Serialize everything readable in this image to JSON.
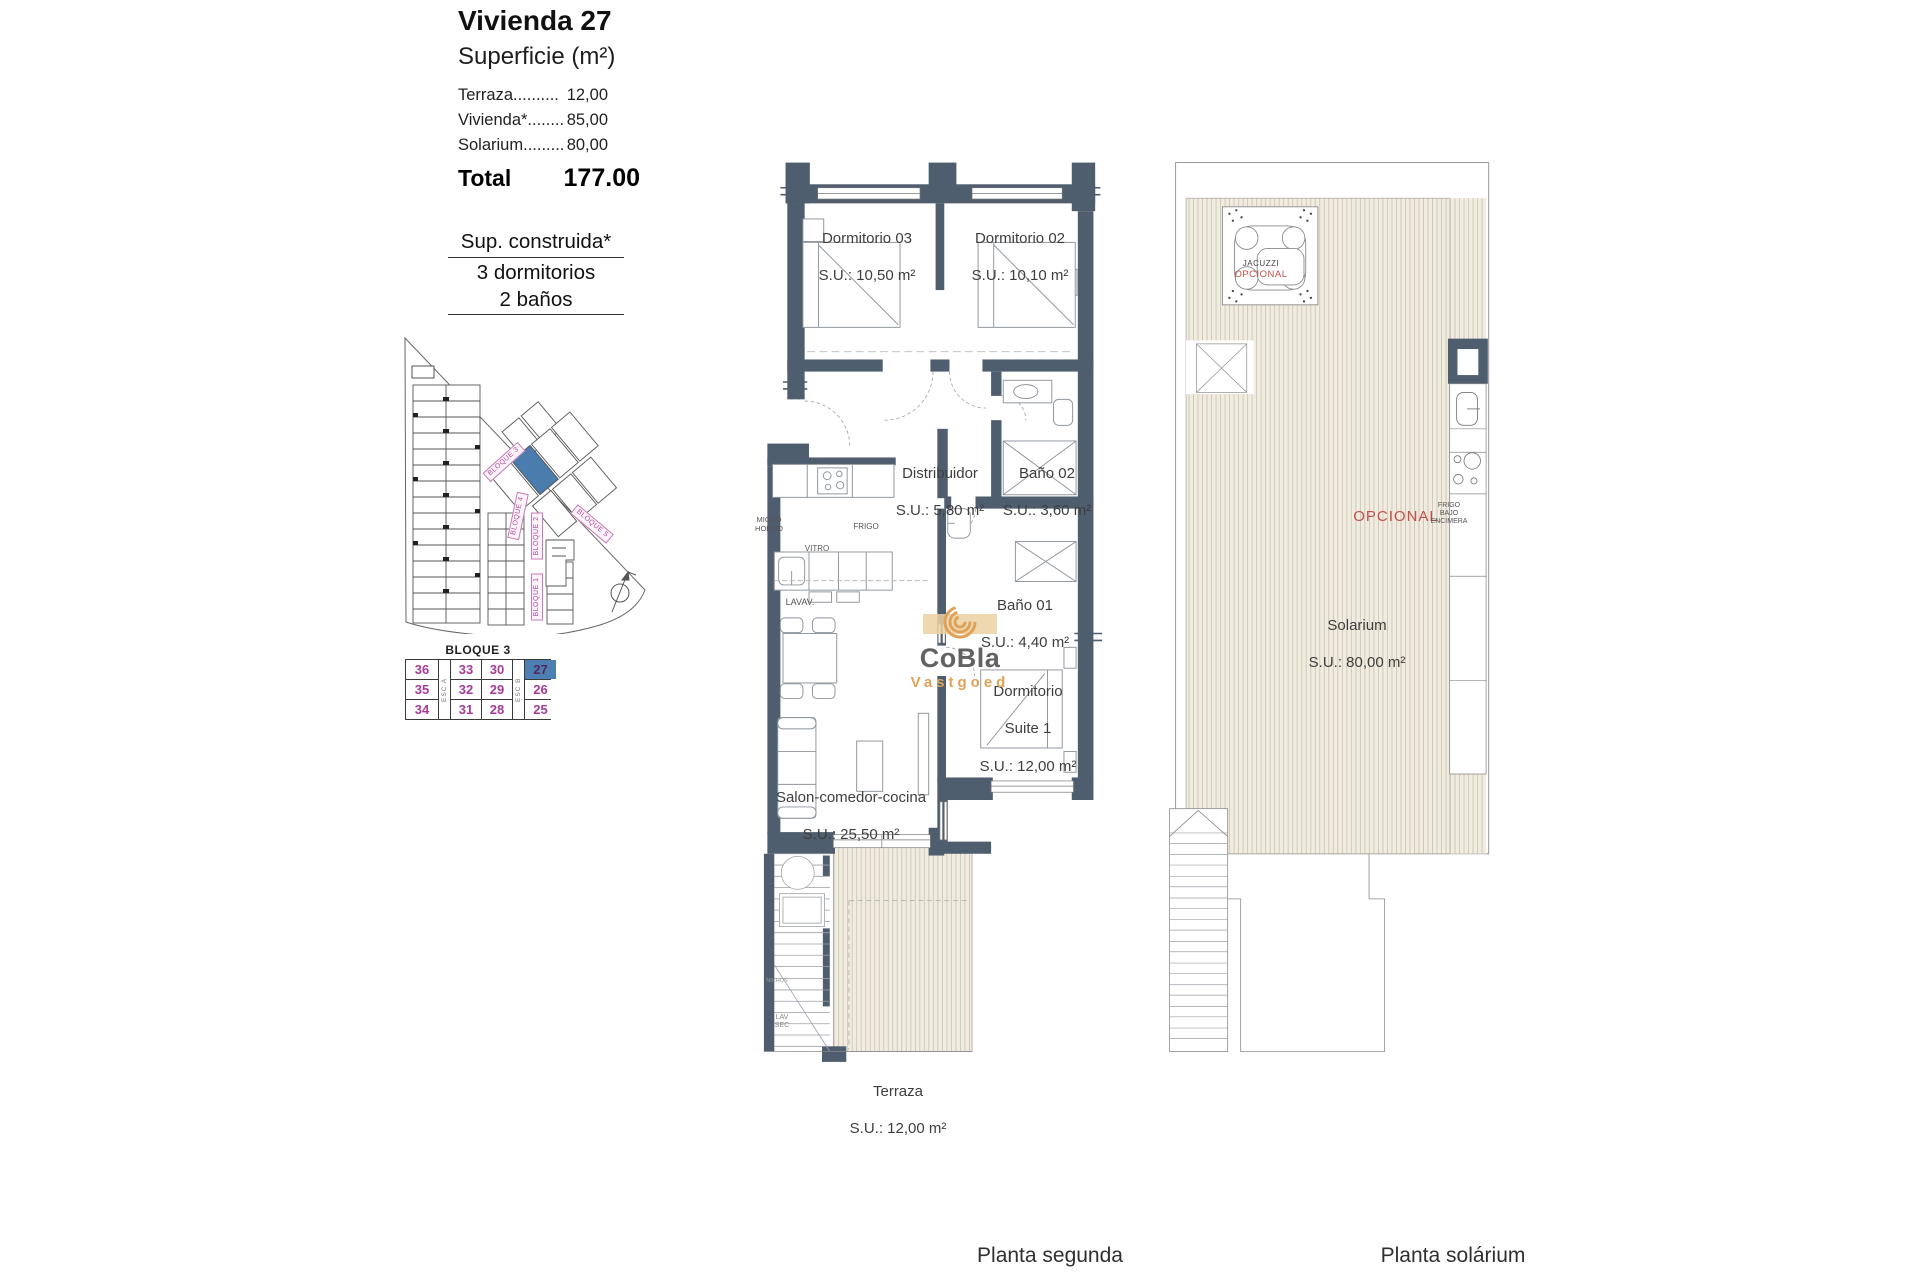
{
  "panel": {
    "title": "Vivienda 27",
    "subtitle": "Superficie (m²)",
    "rows": [
      {
        "label": "Terraza..........",
        "value": "12,00"
      },
      {
        "label": "Vivienda*........",
        "value": "85,00"
      },
      {
        "label": "Solarium.........",
        "value": "80,00"
      }
    ],
    "total_label": "Total",
    "total_value": "177.00",
    "construida_line1": "Sup. construida*",
    "construida_line2": "3 dormitorios",
    "construida_line3": "2 baños"
  },
  "site_plan": {
    "labels": {
      "b3": "BLOQUE 3",
      "b4": "BLOQUE 4",
      "b5": "BLOQUE 5",
      "b2": "BLOQUE 2",
      "b1": "BLOQUE 1"
    },
    "highlight_color": "#4a7cad"
  },
  "bloque_table": {
    "title": "BLOQUE 3",
    "esc_a": "ESC A",
    "esc_b": "ESC B",
    "rows": [
      [
        "36",
        "33",
        "30",
        "27"
      ],
      [
        "35",
        "32",
        "29",
        "26"
      ],
      [
        "34",
        "31",
        "28",
        "25"
      ]
    ],
    "highlighted_unit": "27",
    "number_color": "#a63a9a",
    "highlight_bg": "#4d7fb2"
  },
  "floor_plan": {
    "caption": "Planta segunda",
    "rooms": {
      "dorm03": {
        "name": "Dormitorio 03",
        "area": "S.U.: 10,50 m²"
      },
      "dorm02": {
        "name": "Dormitorio 02",
        "area": "S.U.: 10,10 m²"
      },
      "distribuidor": {
        "name": "Distribuidor",
        "area": "S.U.: 5,80 m²"
      },
      "bano02": {
        "name": "Baño 02",
        "area": "S.U.: 3,60 m²"
      },
      "bano01": {
        "name": "Baño 01",
        "area": "S.U.: 4,40 m²"
      },
      "suite": {
        "name": "Dormitorio",
        "name2": "Suite 1",
        "area": "S.U.: 12,00 m²"
      },
      "salon": {
        "name": "Salon-comedor-cocina",
        "area": "S.U.: 25,50 m²"
      },
      "terraza": {
        "name": "Terraza",
        "area": "S.U.: 12,00 m²"
      }
    },
    "fixtures": {
      "micro": "MICRO\nHORNO",
      "vitro": "VITRO",
      "frigo": "FRIGO",
      "lavav": "LAVAV.",
      "stair_circle": "NICHOS",
      "lav_sec": "LAV\nSEC"
    }
  },
  "solarium_plan": {
    "caption": "Planta solárium",
    "room": {
      "name": "Solarium",
      "area": "S.U.: 80,00 m²"
    },
    "jacuzzi": {
      "line1": "JACUZZI",
      "line2": "OPCIONAL"
    },
    "opcional": "OPCIONAL",
    "frigo_bajo": "FRIGO\nBAJO\nENCIMERA"
  },
  "watermark": {
    "line1": "CoBla",
    "line2": "Vastgoed",
    "accent": "#dfa258"
  },
  "colors": {
    "wall": "#4f5e6e",
    "magenta": "#a63a9a",
    "red": "#c0504d",
    "blue": "#4a7cad",
    "deck_bg": "#f0ece1",
    "deck_line": "#cfc5ad"
  }
}
